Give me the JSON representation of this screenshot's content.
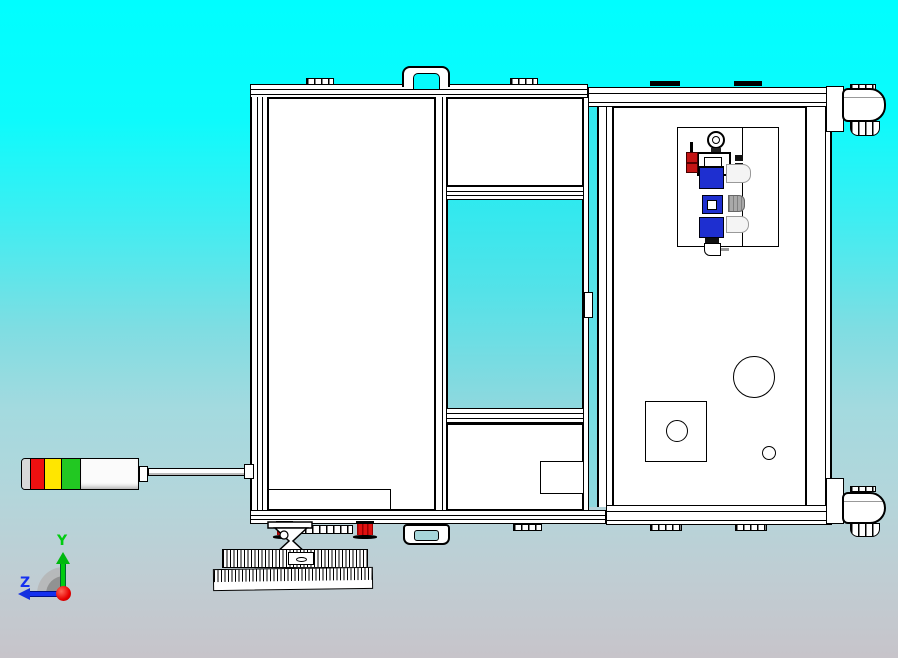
{
  "viewport": {
    "background": {
      "top": "#00FEFF",
      "middle": "#8FD8DE",
      "bottom": "#C7C4CA"
    },
    "line_color": "#000000",
    "panel_color": "#FFFFFF"
  },
  "triad": {
    "y_label": "Y",
    "z_label": "Z",
    "y_color": "#00CC10",
    "z_color": "#1430F0",
    "origin_color": "#E80000",
    "arc_outer_color": "#B4B4B4",
    "arc_inner_color": "#8B8B8B"
  },
  "signal_tower": {
    "segment_colors": {
      "cap": "#D8D8D8",
      "red": "#EE1010",
      "yellow": "#FFE600",
      "green": "#22C822",
      "body": "#FBFBFB"
    }
  },
  "machine": {
    "pneumatic_unit": {
      "block_blue": "#1E2FD0",
      "knob_red": "#C41414",
      "cylinder_gray": "#A9A9A9",
      "cylinder_white": "#F4F4F4"
    },
    "leveling_foot_red": "#E01010",
    "handle_hole_top": "#06FBFD",
    "handle_hole_bottom": "#A6D6DA"
  }
}
